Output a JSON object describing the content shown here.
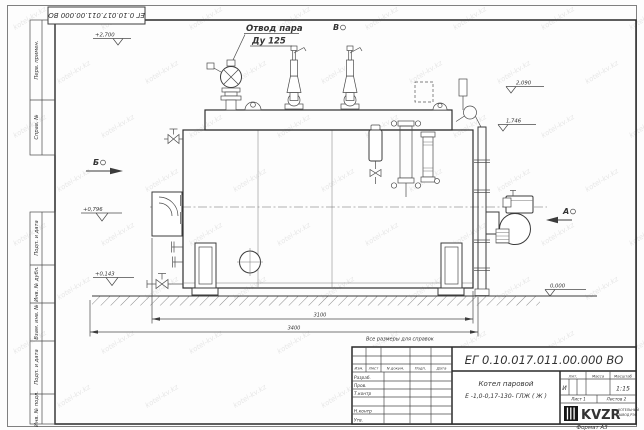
{
  "watermark": {
    "text": "kotel-kv.kz"
  },
  "frame": {
    "doc_number": "ЕГ 0.10.017.011.00.000 ВО",
    "side_labels": [
      "Перв. примен.",
      "Справ. №",
      "Подп. и дата",
      "Инв. № дубл.",
      "Взам. инв. №",
      "Подп. и дата",
      "Инв. № подл."
    ],
    "format_note": "Формат А3"
  },
  "annotations": {
    "steam_outlet_line1": "Отвод пара",
    "steam_outlet_line2": "Ду 125",
    "view_b_top": "В",
    "view_b_left": "Б",
    "view_a_right": "А",
    "elev_plus_2700": "+2,700",
    "elev_2090": "2,090",
    "elev_1746": "1,746",
    "elev_plus_0796": "+0,796",
    "elev_plus_0143": "+0,143",
    "elev_0000": "0,000",
    "dim_span_inner": "3100",
    "dim_span_overall": "3400",
    "ref_note": "Все размеры для справок"
  },
  "title_block": {
    "doc_number": "ЕГ 0.10.017.011.00.000 ВО",
    "change_cols": [
      "Изм.",
      "Лист",
      "N докум.",
      "Подп.",
      "Дата"
    ],
    "sig_rows": [
      "Разраб.",
      "Пров.",
      "Т.контр",
      "Н.контр",
      "Утв."
    ],
    "product_name_line1": "Котел паровой",
    "product_name_line2": "Е -1,0-0,17-130- ГЛЖ ( Ж )",
    "lit_header": "Лит.",
    "lit_value": "И",
    "mass_header": "Масса",
    "scale_header": "Масштаб",
    "scale_value": "1:15",
    "sheet_text": "Лист 1",
    "sheets_text": "Листов 2",
    "logo_text": "KVZR",
    "logo_sub_line1": "КОТЕЛЬНЫЙ",
    "logo_sub_line2": "ЗАВОД РЭП"
  }
}
